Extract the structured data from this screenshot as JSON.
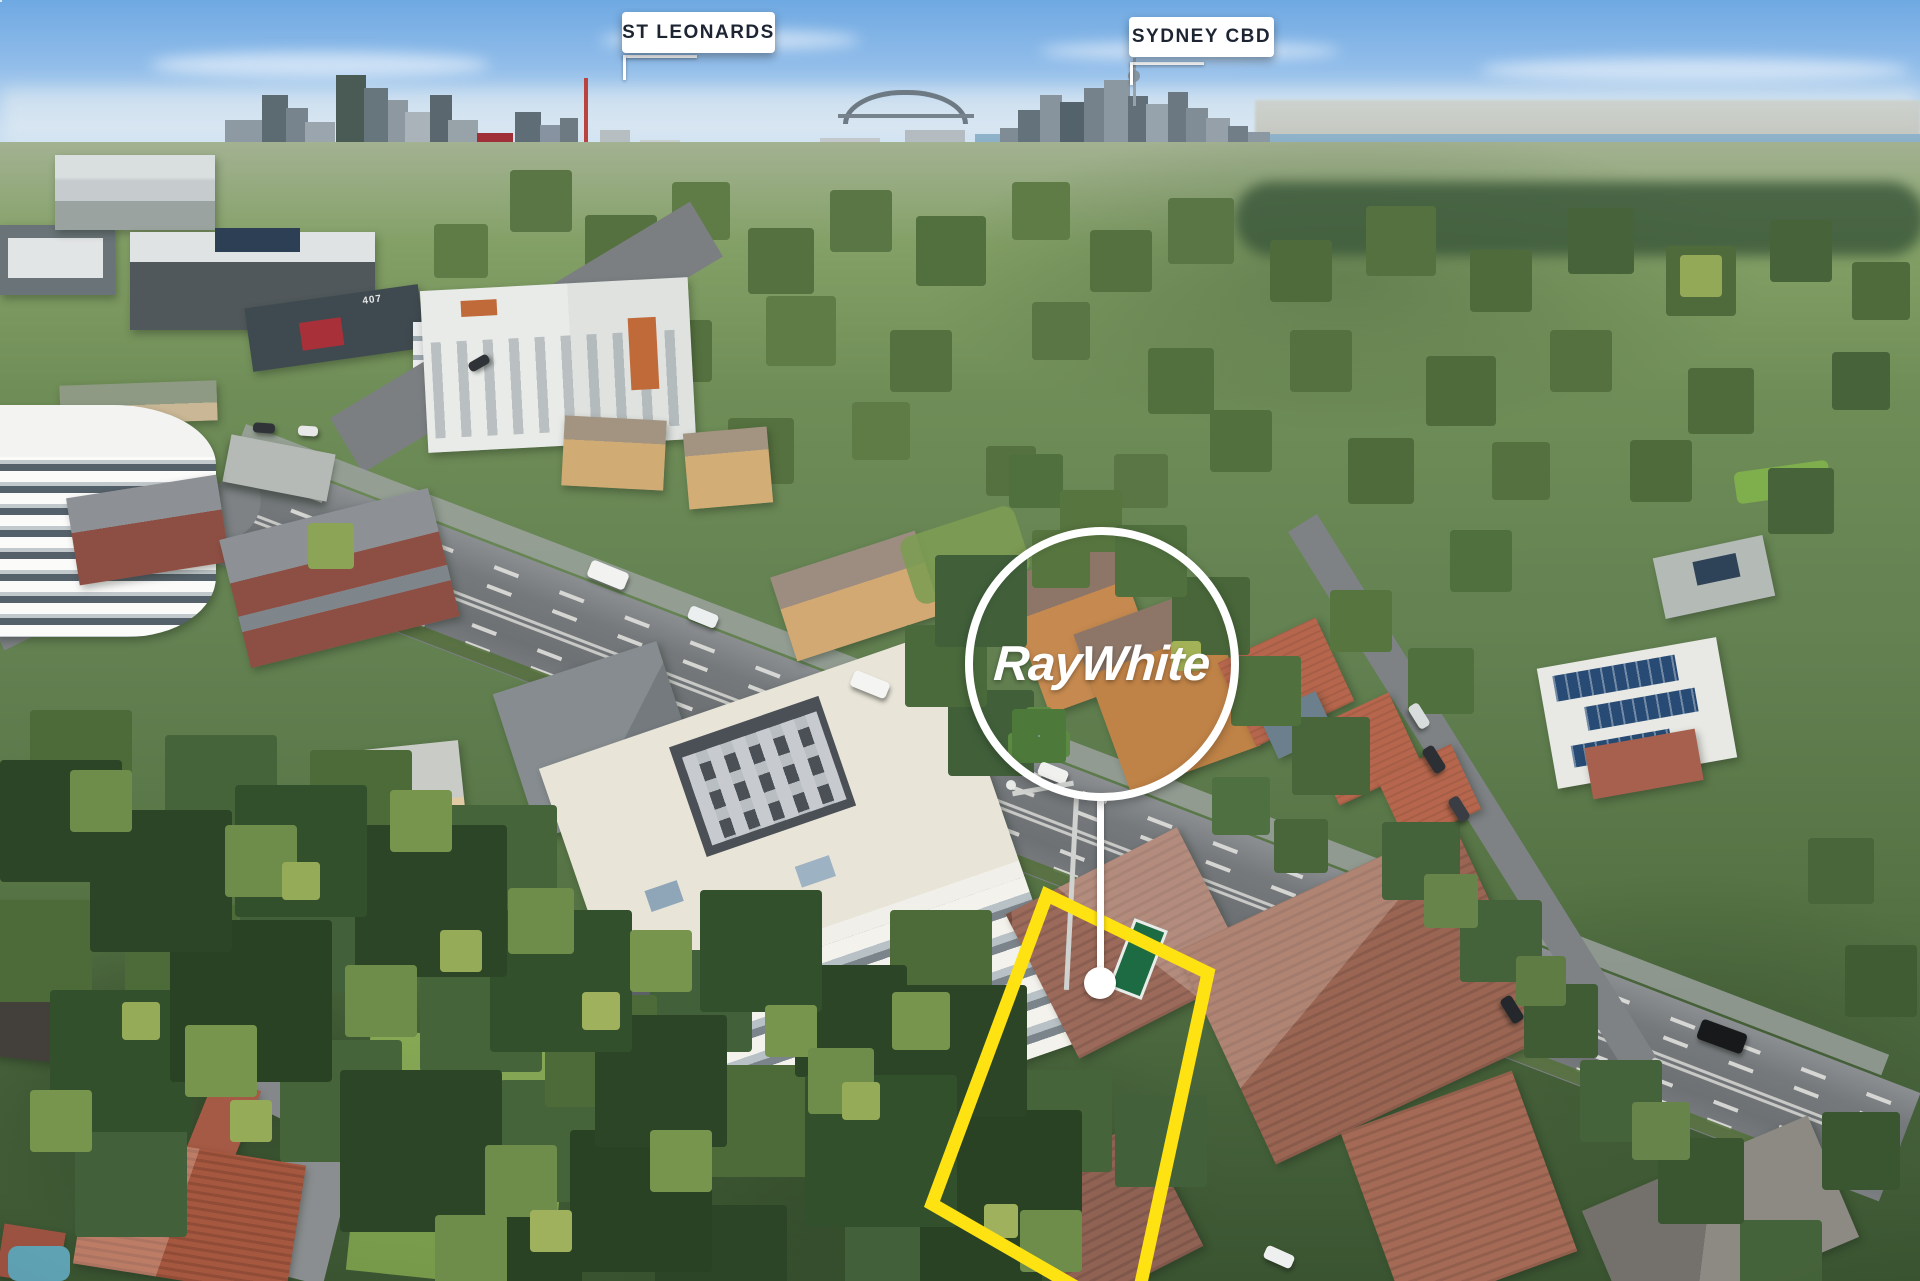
{
  "annotations": {
    "location_labels": [
      {
        "label": "ST LEONARDS"
      },
      {
        "label": "SYDNEY CBD"
      }
    ],
    "watermark": {
      "brand": "RayWhite"
    },
    "boundary": {
      "color": "#ffe212"
    },
    "marker": {
      "color": "#ffffff"
    },
    "distant_signage": "407"
  }
}
